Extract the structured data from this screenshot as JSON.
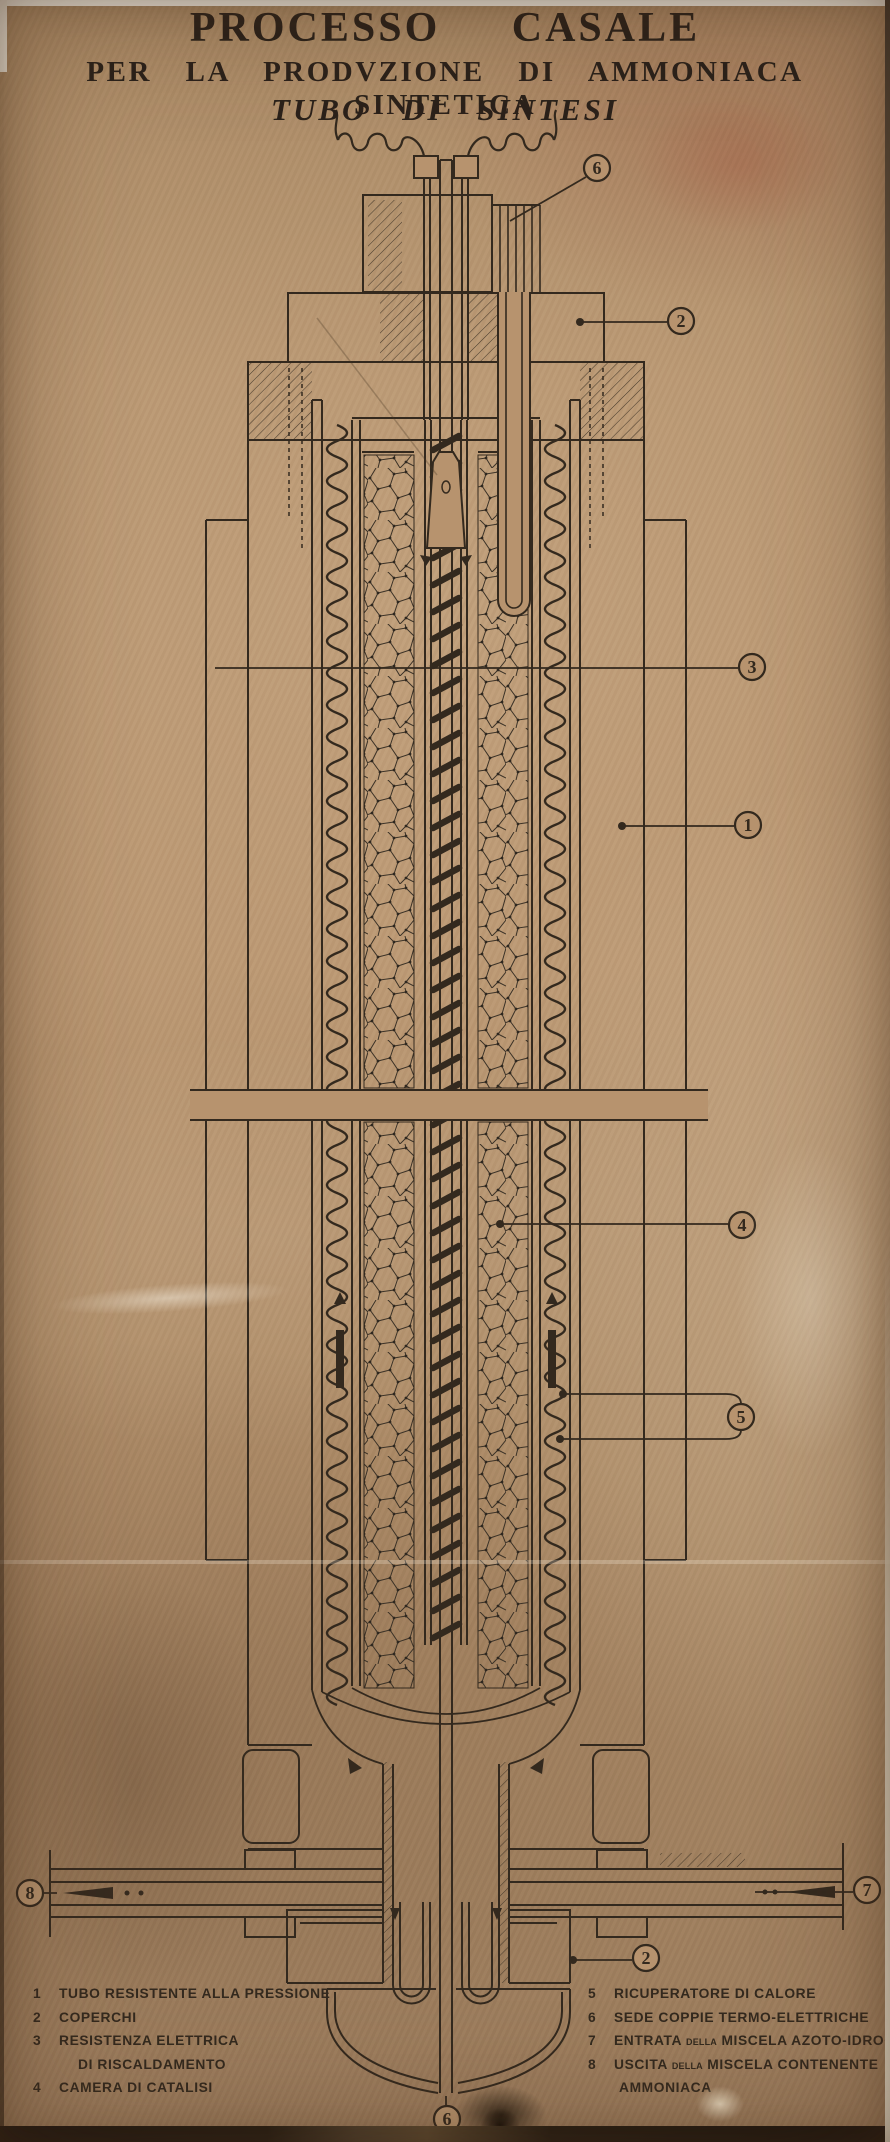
{
  "poster": {
    "title_line1": "PROCESSO CASALE",
    "title_line2": "PER LA PRODVZIONE DI AMMONIACA SINTETICA",
    "title_line3": "TUBO DI SINTESI"
  },
  "callouts": {
    "top_thermo": {
      "label": "6"
    },
    "top_cover": {
      "label": "2"
    },
    "resistance": {
      "label": "3"
    },
    "pressure_tube": {
      "label": "1"
    },
    "catalyst_chamber": {
      "label": "4"
    },
    "heat_recovery": {
      "label": "5"
    },
    "bottom_cover": {
      "label": "2"
    },
    "inlet": {
      "label": "7"
    },
    "outlet": {
      "label": "8"
    },
    "bottom_thermo": {
      "label": "6"
    }
  },
  "legend": {
    "left": [
      {
        "num": "1",
        "text": "TUBO RESISTENTE ALLA PRESSIONE"
      },
      {
        "num": "2",
        "text": "COPERCHI"
      },
      {
        "num": "3",
        "text": "RESISTENZA ELETTRICA"
      },
      {
        "num": "",
        "text": "DI RISCALDAMENTO"
      },
      {
        "num": "4",
        "text": "CAMERA DI CATALISI"
      }
    ],
    "right": [
      {
        "num": "5",
        "text": "RICUPERATORE DI CALORE"
      },
      {
        "num": "6",
        "text": "SEDE COPPIE TERMO-ELETTRICHE"
      },
      {
        "num": "7",
        "a": "ENTRATA",
        "small": "DELLA",
        "b": "MISCELA AZOTO-IDROGENO"
      },
      {
        "num": "8",
        "a": "USCITA",
        "small": "DELLA",
        "b": "MISCELA CONTENENTE"
      },
      {
        "num": "",
        "text": "AMMONIACA"
      }
    ]
  },
  "colors": {
    "paper": "#b7936e",
    "ink": "#33291e"
  }
}
